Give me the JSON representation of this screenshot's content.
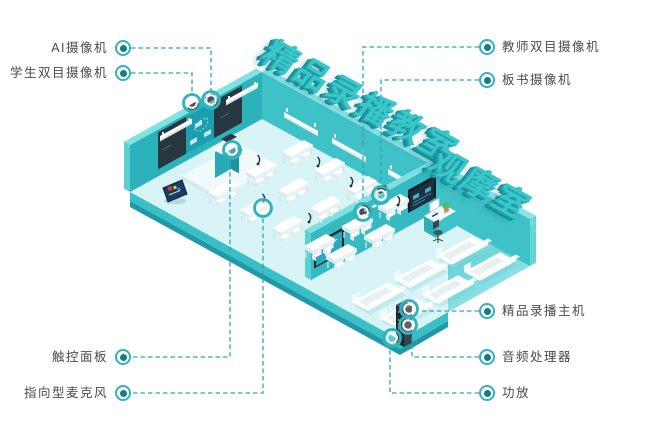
{
  "title": {
    "line1": "精品录播教室",
    "line2": "观摩室"
  },
  "callouts": {
    "left": [
      {
        "label": "AI摄像机"
      },
      {
        "label": "学生双目摄像机"
      },
      {
        "label": "触控面板"
      },
      {
        "label": "指向型麦克风"
      }
    ],
    "right": [
      {
        "label": "教师双目摄像机"
      },
      {
        "label": "板书摄像机"
      },
      {
        "label": "精品录播主机"
      },
      {
        "label": "音频处理器"
      },
      {
        "label": "功放"
      }
    ]
  },
  "colors": {
    "accent_teal": "#2fb3bd",
    "title_teal": "#3bc6c8",
    "leader_line": "#2ba7b4",
    "label_text": "#4b4b4b",
    "wall_teal": "#31b6bf",
    "floor_cyan": "#d8f4f6",
    "dark_panel": "#27363f"
  }
}
